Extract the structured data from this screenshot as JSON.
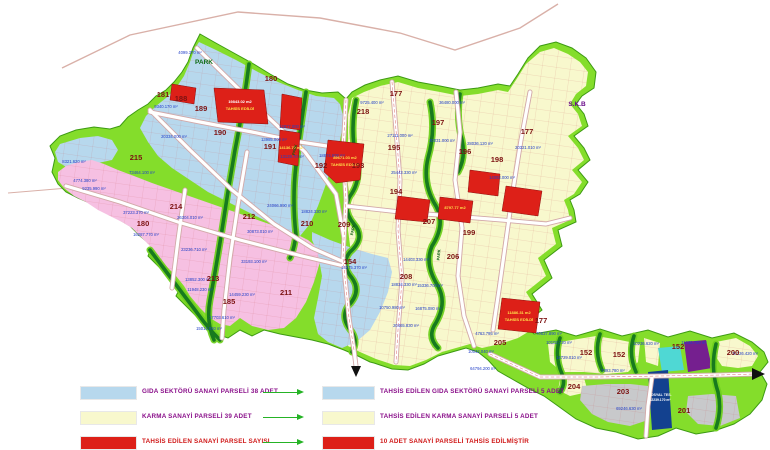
{
  "colors": {
    "boundary_green": "#84dd2b",
    "boundary_edge": "#3c9a12",
    "food_blue": "#b7d8ed",
    "karma_yellow": "#f8f8cd",
    "pink_zone": "#f6c0e2",
    "allocated_red": "#dd2018",
    "creek_dark": "#177a1e",
    "creek_light": "#6fd01f",
    "road_casing": "#d2a8a8",
    "road_white": "#ffffff",
    "gray_parcel": "#c8c9cb",
    "dark_blue_parcel": "#13418f",
    "purple_parcel": "#751f8f",
    "cyan_parcel": "#4fd8d4",
    "grid_red": "#c86060",
    "topline_pink": "#d9b0a8",
    "arrow_green": "#25b325",
    "arrow_black": "#111111"
  },
  "legend": {
    "left": [
      {
        "swatch": "#b7d8ed",
        "label": "GIDA SEKTÖRÜ SANAYİ PARSELİ 38 ADET",
        "color": "#8a0f8a"
      },
      {
        "swatch": "#f8f8cd",
        "label": "KARMA SANAYİ PARSELİ 39 ADET",
        "color": "#8a0f8a"
      },
      {
        "swatch": "#dd2018",
        "label": "TAHSİS EDİLEN SANAYİ PARSEL SAYISI",
        "color": "#d01818"
      }
    ],
    "right": [
      {
        "swatch": "#b7d8ed",
        "label": "TAHSİS EDİLEN GIDA SEKTÖRÜ SANAYİ PARSELİ 5 ADET",
        "color": "#8a0f8a"
      },
      {
        "swatch": "#f8f8cd",
        "label": "TAHSİS EDİLEN KARMA SANAYİ PARSELİ 5 ADET",
        "color": "#8a0f8a"
      },
      {
        "swatch": "#dd2018",
        "label": "10 ADET SANAYİ PARSELİ TAHSİS EDİLMİŞTİR",
        "color": "#d01818"
      }
    ]
  },
  "map": {
    "block_labels": [
      {
        "text": "181",
        "x": 163,
        "y": 97
      },
      {
        "text": "188",
        "x": 181,
        "y": 101
      },
      {
        "text": "189",
        "x": 201,
        "y": 111
      },
      {
        "text": "190",
        "x": 220,
        "y": 135
      },
      {
        "text": "191",
        "x": 270,
        "y": 149
      },
      {
        "text": "180",
        "x": 271,
        "y": 81
      },
      {
        "text": "215",
        "x": 136,
        "y": 160
      },
      {
        "text": "218",
        "x": 363,
        "y": 114
      },
      {
        "text": "177",
        "x": 396,
        "y": 96
      },
      {
        "text": "197",
        "x": 438,
        "y": 125
      },
      {
        "text": "195",
        "x": 394,
        "y": 150
      },
      {
        "text": "196",
        "x": 465,
        "y": 154
      },
      {
        "text": "198",
        "x": 497,
        "y": 162
      },
      {
        "text": "177",
        "x": 527,
        "y": 134
      },
      {
        "text": "192",
        "x": 321,
        "y": 168
      },
      {
        "text": "193",
        "x": 358,
        "y": 168
      },
      {
        "text": "194",
        "x": 396,
        "y": 194
      },
      {
        "text": "207",
        "x": 429,
        "y": 224
      },
      {
        "text": "199",
        "x": 469,
        "y": 235
      },
      {
        "text": "206",
        "x": 453,
        "y": 259
      },
      {
        "text": "210",
        "x": 307,
        "y": 226
      },
      {
        "text": "209",
        "x": 344,
        "y": 227
      },
      {
        "text": "154",
        "x": 350,
        "y": 264
      },
      {
        "text": "208",
        "x": 406,
        "y": 279
      },
      {
        "text": "214",
        "x": 176,
        "y": 209
      },
      {
        "text": "180",
        "x": 143,
        "y": 226
      },
      {
        "text": "212",
        "x": 249,
        "y": 219
      },
      {
        "text": "213",
        "x": 213,
        "y": 281
      },
      {
        "text": "211",
        "x": 286,
        "y": 295
      },
      {
        "text": "185",
        "x": 229,
        "y": 304
      },
      {
        "text": "205",
        "x": 500,
        "y": 345
      },
      {
        "text": "177",
        "x": 541,
        "y": 323
      },
      {
        "text": "152",
        "x": 586,
        "y": 355
      },
      {
        "text": "152",
        "x": 619,
        "y": 357
      },
      {
        "text": "152",
        "x": 678,
        "y": 349
      },
      {
        "text": "200",
        "x": 733,
        "y": 355
      },
      {
        "text": "204",
        "x": 574,
        "y": 389
      },
      {
        "text": "203",
        "x": 623,
        "y": 394
      },
      {
        "text": "201",
        "x": 684,
        "y": 413
      }
    ],
    "special_labels": [
      {
        "text": "PARK",
        "x": 204,
        "y": 64,
        "color": "#0b6b14",
        "size": 6.5
      },
      {
        "text": "S.K.B",
        "x": 577,
        "y": 106,
        "color": "#6a0d8a",
        "size": 6.5
      },
      {
        "text": "PARK",
        "x": 354,
        "y": 230,
        "color": "#0a5c10",
        "size": 4,
        "rotate": -80
      },
      {
        "text": "PARK",
        "x": 440,
        "y": 255,
        "color": "#0a5c10",
        "size": 4,
        "rotate": -85
      },
      {
        "text": "PARK",
        "x": 296,
        "y": 150,
        "color": "#0a5c10",
        "size": 4,
        "rotate": -75
      },
      {
        "text": "SOSYAL TES.",
        "x": 660,
        "y": 396,
        "color": "#ffffff",
        "size": 3.6
      },
      {
        "text": "12239.170 m²",
        "x": 660,
        "y": 401,
        "color": "#ffffff",
        "size": 3.4
      }
    ],
    "allocated_labels": [
      {
        "text": "19843.02 m2",
        "x": 240,
        "y": 103,
        "color": "#ffffff"
      },
      {
        "text": "TAHSİS EDİLDİ",
        "x": 240,
        "y": 110,
        "color": "#ffe24a"
      },
      {
        "text": "14136.70 m2",
        "x": 291,
        "y": 149,
        "color": "#ffe24a"
      },
      {
        "text": "89671.03 m2",
        "x": 345,
        "y": 159,
        "color": "#ffe24a"
      },
      {
        "text": "TAHSİS EDİLDİ",
        "x": 345,
        "y": 166,
        "color": "#ffe24a"
      },
      {
        "text": "8797.77 m2",
        "x": 455,
        "y": 209,
        "color": "#ffe24a"
      },
      {
        "text": "11886.31 m2",
        "x": 519,
        "y": 314,
        "color": "#ffe24a"
      },
      {
        "text": "TAHSİS EDİLDİ",
        "x": 519,
        "y": 321,
        "color": "#ffe24a"
      }
    ],
    "area_labels": [
      {
        "text": "4099.370 m²",
        "x": 190,
        "y": 54
      },
      {
        "text": "9340.170 m²",
        "x": 166,
        "y": 108
      },
      {
        "text": "20334.000 m²",
        "x": 174,
        "y": 138
      },
      {
        "text": "73464.100 m²",
        "x": 142,
        "y": 174
      },
      {
        "text": "13985.000 m²",
        "x": 274,
        "y": 141
      },
      {
        "text": "12877.000 m²",
        "x": 292,
        "y": 128
      },
      {
        "text": "16287.770 m²",
        "x": 146,
        "y": 236
      },
      {
        "text": "37223.370 m²",
        "x": 136,
        "y": 214
      },
      {
        "text": "26304.010 m²",
        "x": 190,
        "y": 219
      },
      {
        "text": "23236.710 m²",
        "x": 194,
        "y": 251
      },
      {
        "text": "30873.010 m²",
        "x": 260,
        "y": 233
      },
      {
        "text": "33193.100 m²",
        "x": 254,
        "y": 263
      },
      {
        "text": "24066.990 m²",
        "x": 280,
        "y": 207
      },
      {
        "text": "13852.300 m²",
        "x": 198,
        "y": 281
      },
      {
        "text": "11948.230 m²",
        "x": 200,
        "y": 291
      },
      {
        "text": "17703.610 m²",
        "x": 222,
        "y": 319
      },
      {
        "text": "15014.040 m²",
        "x": 209,
        "y": 330
      },
      {
        "text": "14459.230 m²",
        "x": 242,
        "y": 296
      },
      {
        "text": "9725.400 m²",
        "x": 372,
        "y": 104
      },
      {
        "text": "36480.000 m²",
        "x": 452,
        "y": 104
      },
      {
        "text": "27111.000 m²",
        "x": 400,
        "y": 137
      },
      {
        "text": "20031.000 m²",
        "x": 442,
        "y": 142
      },
      {
        "text": "28036.120 m²",
        "x": 480,
        "y": 145
      },
      {
        "text": "20321.010 m²",
        "x": 528,
        "y": 149
      },
      {
        "text": "25443.330 m²",
        "x": 404,
        "y": 174
      },
      {
        "text": "14093.000 m²",
        "x": 502,
        "y": 179
      },
      {
        "text": "18874.600 m²",
        "x": 332,
        "y": 157
      },
      {
        "text": "18824.330 m²",
        "x": 314,
        "y": 213
      },
      {
        "text": "14275.370 m²",
        "x": 354,
        "y": 269
      },
      {
        "text": "14403.330 m²",
        "x": 416,
        "y": 261
      },
      {
        "text": "15336.700 m²",
        "x": 430,
        "y": 287
      },
      {
        "text": "18834.330 m²",
        "x": 404,
        "y": 286
      },
      {
        "text": "10750.980 m²",
        "x": 392,
        "y": 309
      },
      {
        "text": "16875.080 m²",
        "x": 428,
        "y": 310
      },
      {
        "text": "20465.830 m²",
        "x": 406,
        "y": 327
      },
      {
        "text": "70637.890 m²",
        "x": 549,
        "y": 335
      },
      {
        "text": "10102.720 m²",
        "x": 559,
        "y": 344
      },
      {
        "text": "4763.795 m²",
        "x": 487,
        "y": 335
      },
      {
        "text": "10042.040 m²",
        "x": 481,
        "y": 353
      },
      {
        "text": "64794.200 m²",
        "x": 483,
        "y": 370
      },
      {
        "text": "10236.620 m²",
        "x": 646,
        "y": 345
      },
      {
        "text": "11035.700 m²",
        "x": 694,
        "y": 344
      },
      {
        "text": "14729.010 m²",
        "x": 569,
        "y": 359
      },
      {
        "text": "7893.780 m²",
        "x": 613,
        "y": 372
      },
      {
        "text": "69246.630 m²",
        "x": 629,
        "y": 410
      },
      {
        "text": "10226.420 m²",
        "x": 745,
        "y": 355
      },
      {
        "text": "8321.620 m²",
        "x": 74,
        "y": 163
      },
      {
        "text": "4774.380 m²",
        "x": 85,
        "y": 182
      },
      {
        "text": "9235.990 m²",
        "x": 94,
        "y": 190
      },
      {
        "text": "13128.70 m²",
        "x": 292,
        "y": 158
      }
    ]
  }
}
